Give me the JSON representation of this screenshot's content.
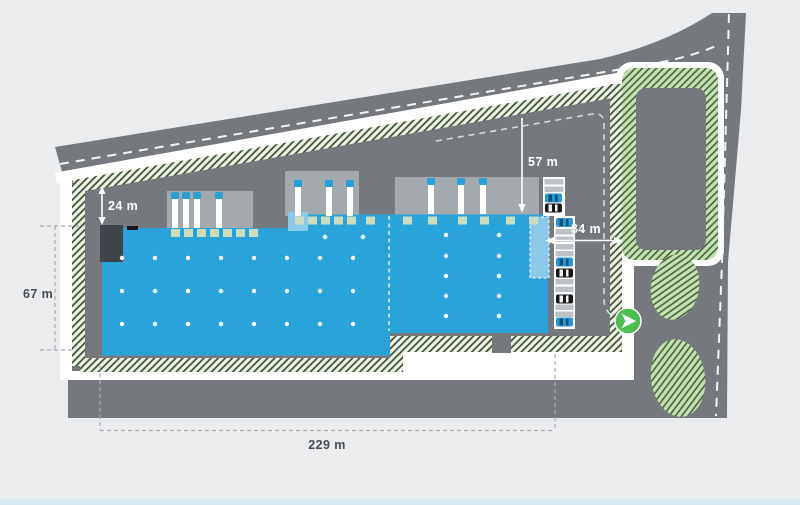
{
  "plan": {
    "title": "warehouse-site-plan",
    "dimensions": {
      "setback_top": "24 m",
      "depth_right": "57 m",
      "access_width": "34 m",
      "side_height": "67 m",
      "total_length": "229 m"
    },
    "markers": {
      "entrance": "navigation-arrow"
    },
    "colors": {
      "background": "#eaecee",
      "road_gray": "#75797d",
      "building_blue": "#2aa2da",
      "building_light_blue": "#8bc9ea",
      "landscape_band_bg": "#ebf4e3",
      "landscape_fill": "#c2e3b0",
      "hatch_line": "#3d4936",
      "marker_green": "#4cbf4e",
      "apron_gray": "#a4a9ad",
      "dock_door": "#ccdcbf",
      "annex_dark": "#3d454b"
    }
  }
}
